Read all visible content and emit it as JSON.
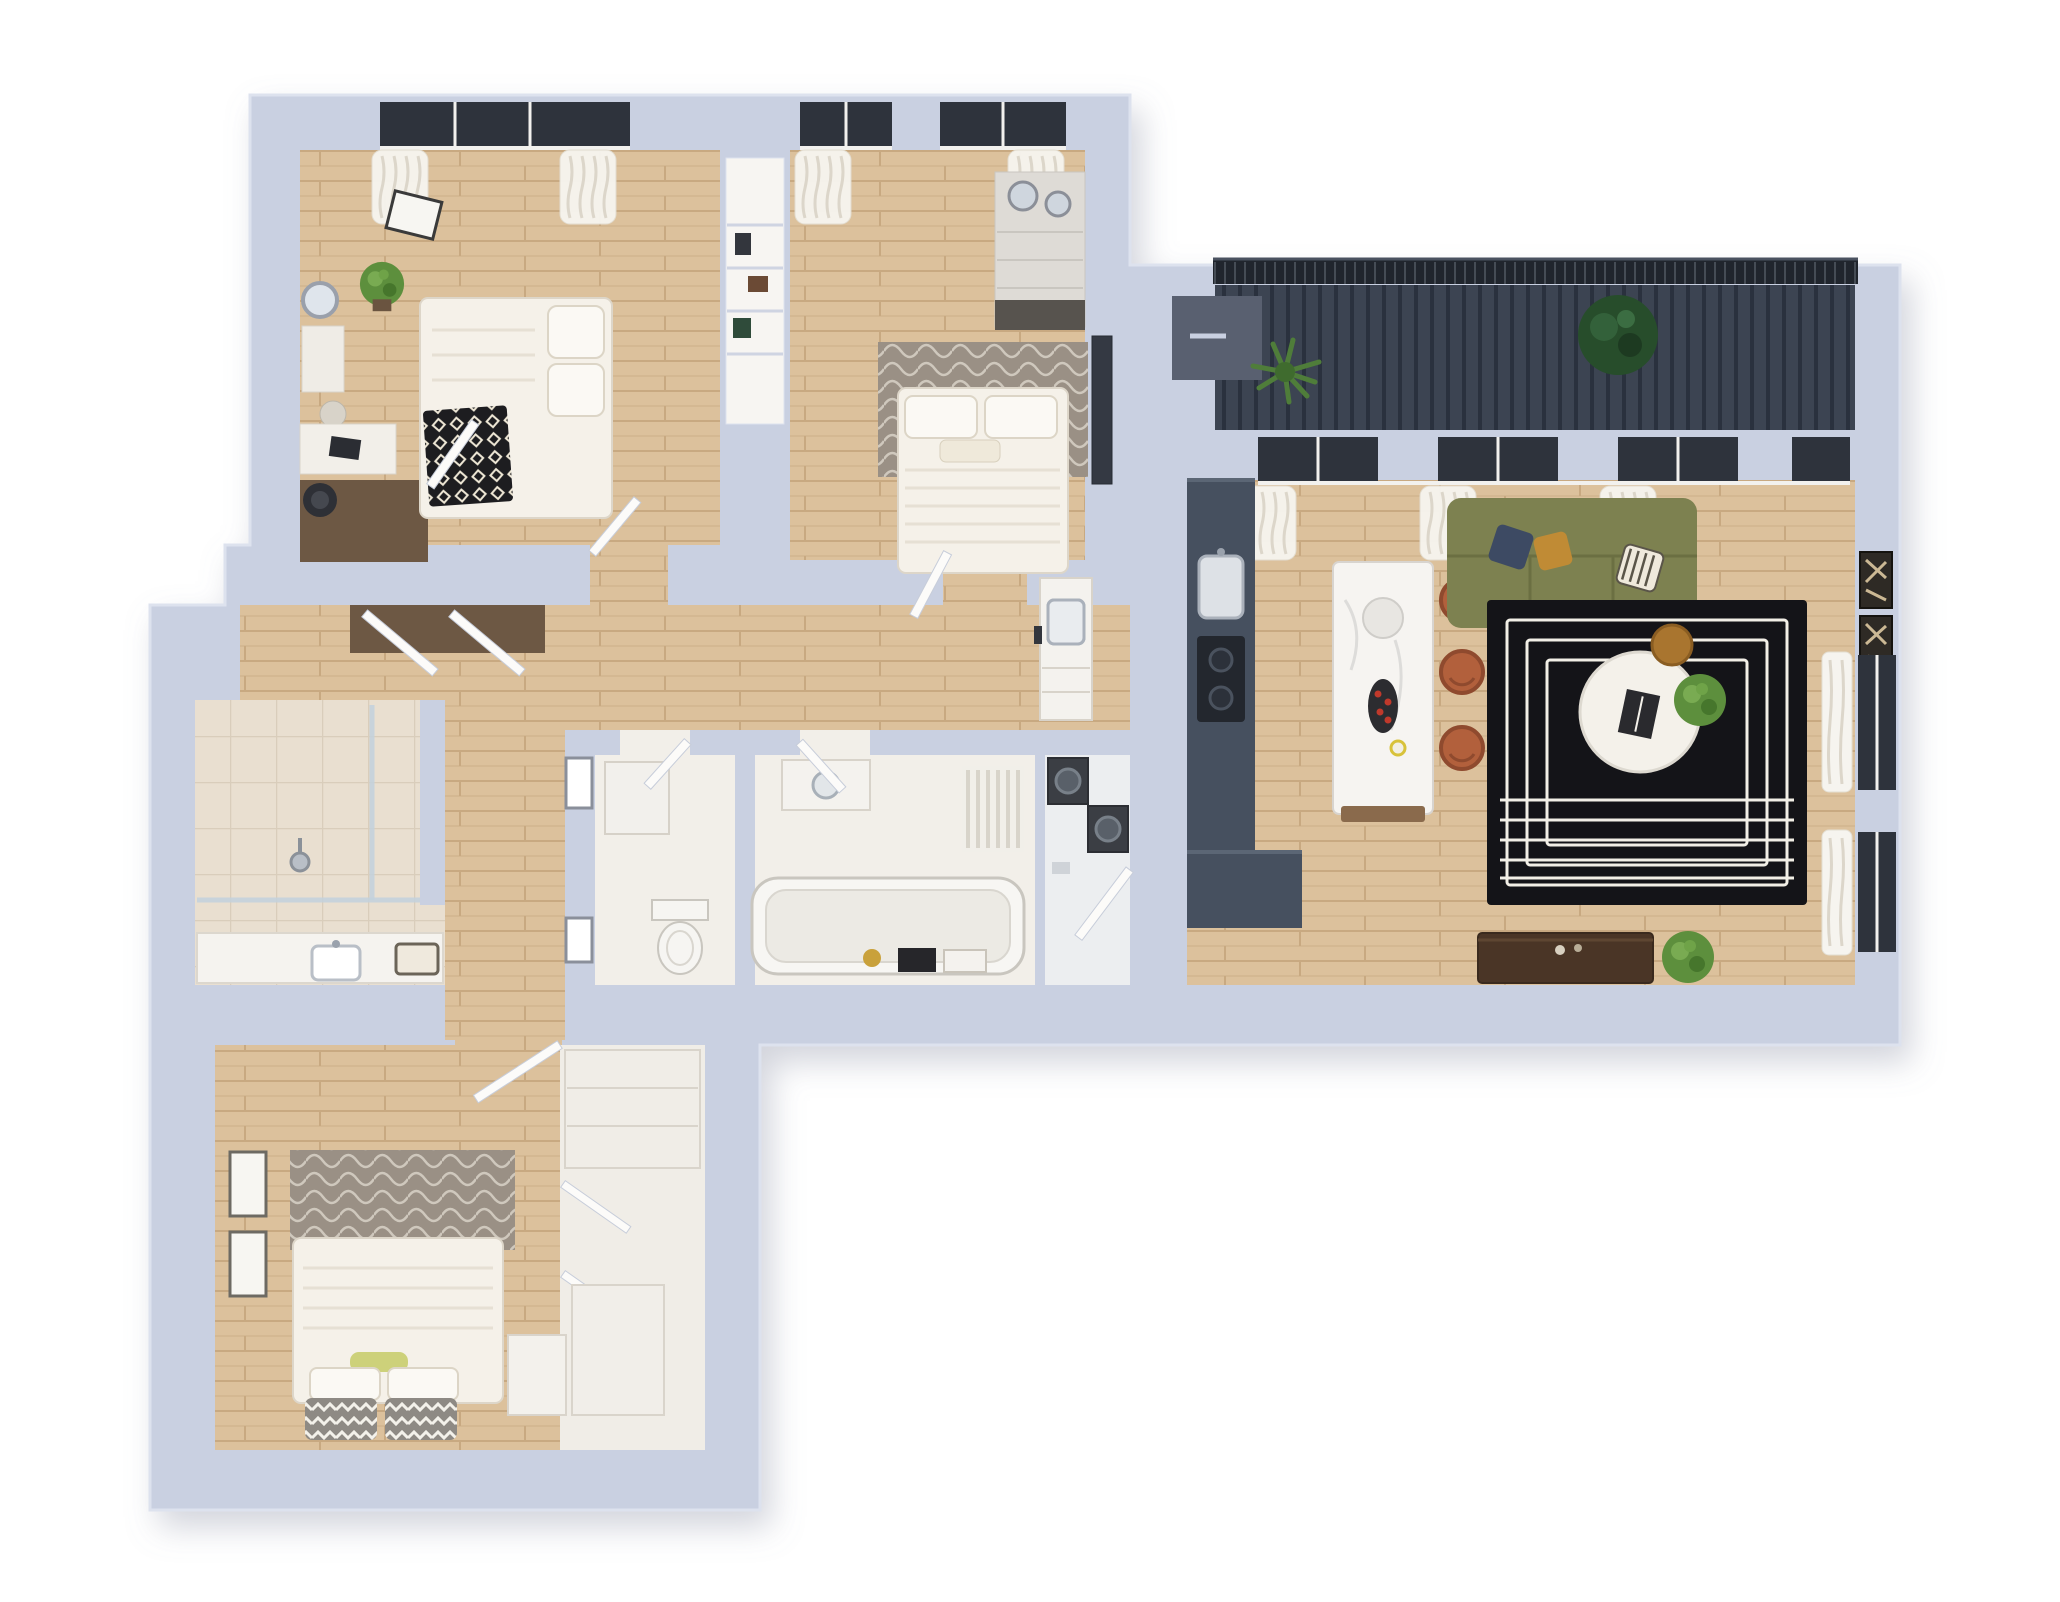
{
  "floorplan": {
    "type": "3d-isometric-apartment-render",
    "background": "#ffffff",
    "palette": {
      "wall": "#c9d0e1",
      "wall_edge": "#dde2ee",
      "wall_shadow": "#8a90a4",
      "floor_wood": "#dcc19c",
      "wood_line": "#c8a981",
      "wood_line2": "#d2b58e",
      "floor_tile": "#e9dfd0",
      "tile_line": "#d9cdbb",
      "floor_white": "#f2efe9",
      "floor_laundry": "#eceef0",
      "closet_floor": "#f0ede7",
      "deck": "#3c4452",
      "deck_line": "#2a313e",
      "railing": "#20252d",
      "railing_slat": "#9aa3b3",
      "counter_navy": "#46505f",
      "counter_edge": "#5b6675",
      "island_white": "#f6f4f1",
      "island_base": "#8a6a4c",
      "sofa_green": "#7d8150",
      "sofa_seam": "#6b6f42",
      "rug_black": "#141418",
      "rug_line": "#f2efe6",
      "stool_terracotta": "#b2603c",
      "stool_rim": "#8f4a2e",
      "plant_green": "#5d8f3d",
      "plant_light": "#79ab52",
      "plant_dark": "#274d2b",
      "palm_green": "#4f7d3a",
      "closet_dark_floor": "#6d5844",
      "walnut": "#4a3526",
      "textile_gray": "#9a9085",
      "textile_wave": "#cfc8bd",
      "duvet": "#f5f1e9",
      "duvet_line": "#e6e0d4",
      "pillow_zig_base": "#8e8a84",
      "throw_black": "#1d1d20",
      "glass_dark": "#2e333c",
      "curtain": "#f7f5f0",
      "curtain_line": "#dcd6ca",
      "appliance_dark": "#3b3e44",
      "door_leaf": "#fcfbf9",
      "door_edge": "#c7cdda",
      "frame_dark": "#2e2a25",
      "gold": "#c9a13b",
      "bolster_yellow": "#cdd17a",
      "fruit_red": "#c0392b",
      "mirror_glass": "#cfd6de",
      "planter_gray": "#596070"
    },
    "rooms": [
      {
        "id": "bedroom-1",
        "floor": "wood",
        "furniture": [
          "double-bed",
          "diamond-throw",
          "pillows",
          "potted-plant",
          "wall-art-frame",
          "vanity-mirror",
          "vanity-table",
          "desk",
          "desk-chair",
          "wardrobe-dark-floor",
          "window-curtains"
        ]
      },
      {
        "id": "bedroom-2",
        "floor": "wood",
        "furniture": [
          "double-bed",
          "wavy-rug",
          "dresser-with-mirrors",
          "tall-mirror",
          "window-curtains"
        ]
      },
      {
        "id": "between-closet-niche",
        "floor": "shelving",
        "furniture": [
          "shelf-items"
        ]
      },
      {
        "id": "entry-hall",
        "floor": "wood",
        "furniture": [
          "wall-frames",
          "bathroom-vanity-sink",
          "open-closet-doors",
          "dark-closet-floor"
        ]
      },
      {
        "id": "wc-storage",
        "floor": "white",
        "furniture": [
          "boiler-cabinet",
          "toilet"
        ]
      },
      {
        "id": "bathroom",
        "floor": "white",
        "furniture": [
          "bathtub",
          "radiator",
          "vanity-sink",
          "toiletry-shelf"
        ]
      },
      {
        "id": "laundry",
        "floor": "white",
        "furniture": [
          "washer",
          "dryer"
        ]
      },
      {
        "id": "shower-room",
        "floor": "tile",
        "furniture": [
          "glass-shower",
          "shower-head"
        ]
      },
      {
        "id": "vanity-corridor",
        "floor": "tile",
        "furniture": [
          "counter",
          "sink",
          "tray"
        ]
      },
      {
        "id": "bedroom-3",
        "floor": "wood",
        "furniture": [
          "double-bed",
          "wavy-rug",
          "chevron-pillows",
          "yellow-bolster",
          "wall-frames",
          "wardrobe-open-doors",
          "nightstand",
          "lower-cabinet"
        ]
      },
      {
        "id": "living-kitchen",
        "floor": "wood",
        "furniture": [
          "green-sofa",
          "throw-pillows",
          "black-maze-rug",
          "round-coffee-table",
          "side-table",
          "potted-plant",
          "kitchen-counter",
          "sink",
          "cooktop",
          "kitchen-island",
          "bar-stools",
          "tv-console",
          "wall-art-frames",
          "windows-curtains"
        ]
      },
      {
        "id": "balcony",
        "floor": "deck",
        "furniture": [
          "railing",
          "palm-plant",
          "leafy-plant",
          "planter-box"
        ]
      }
    ]
  }
}
